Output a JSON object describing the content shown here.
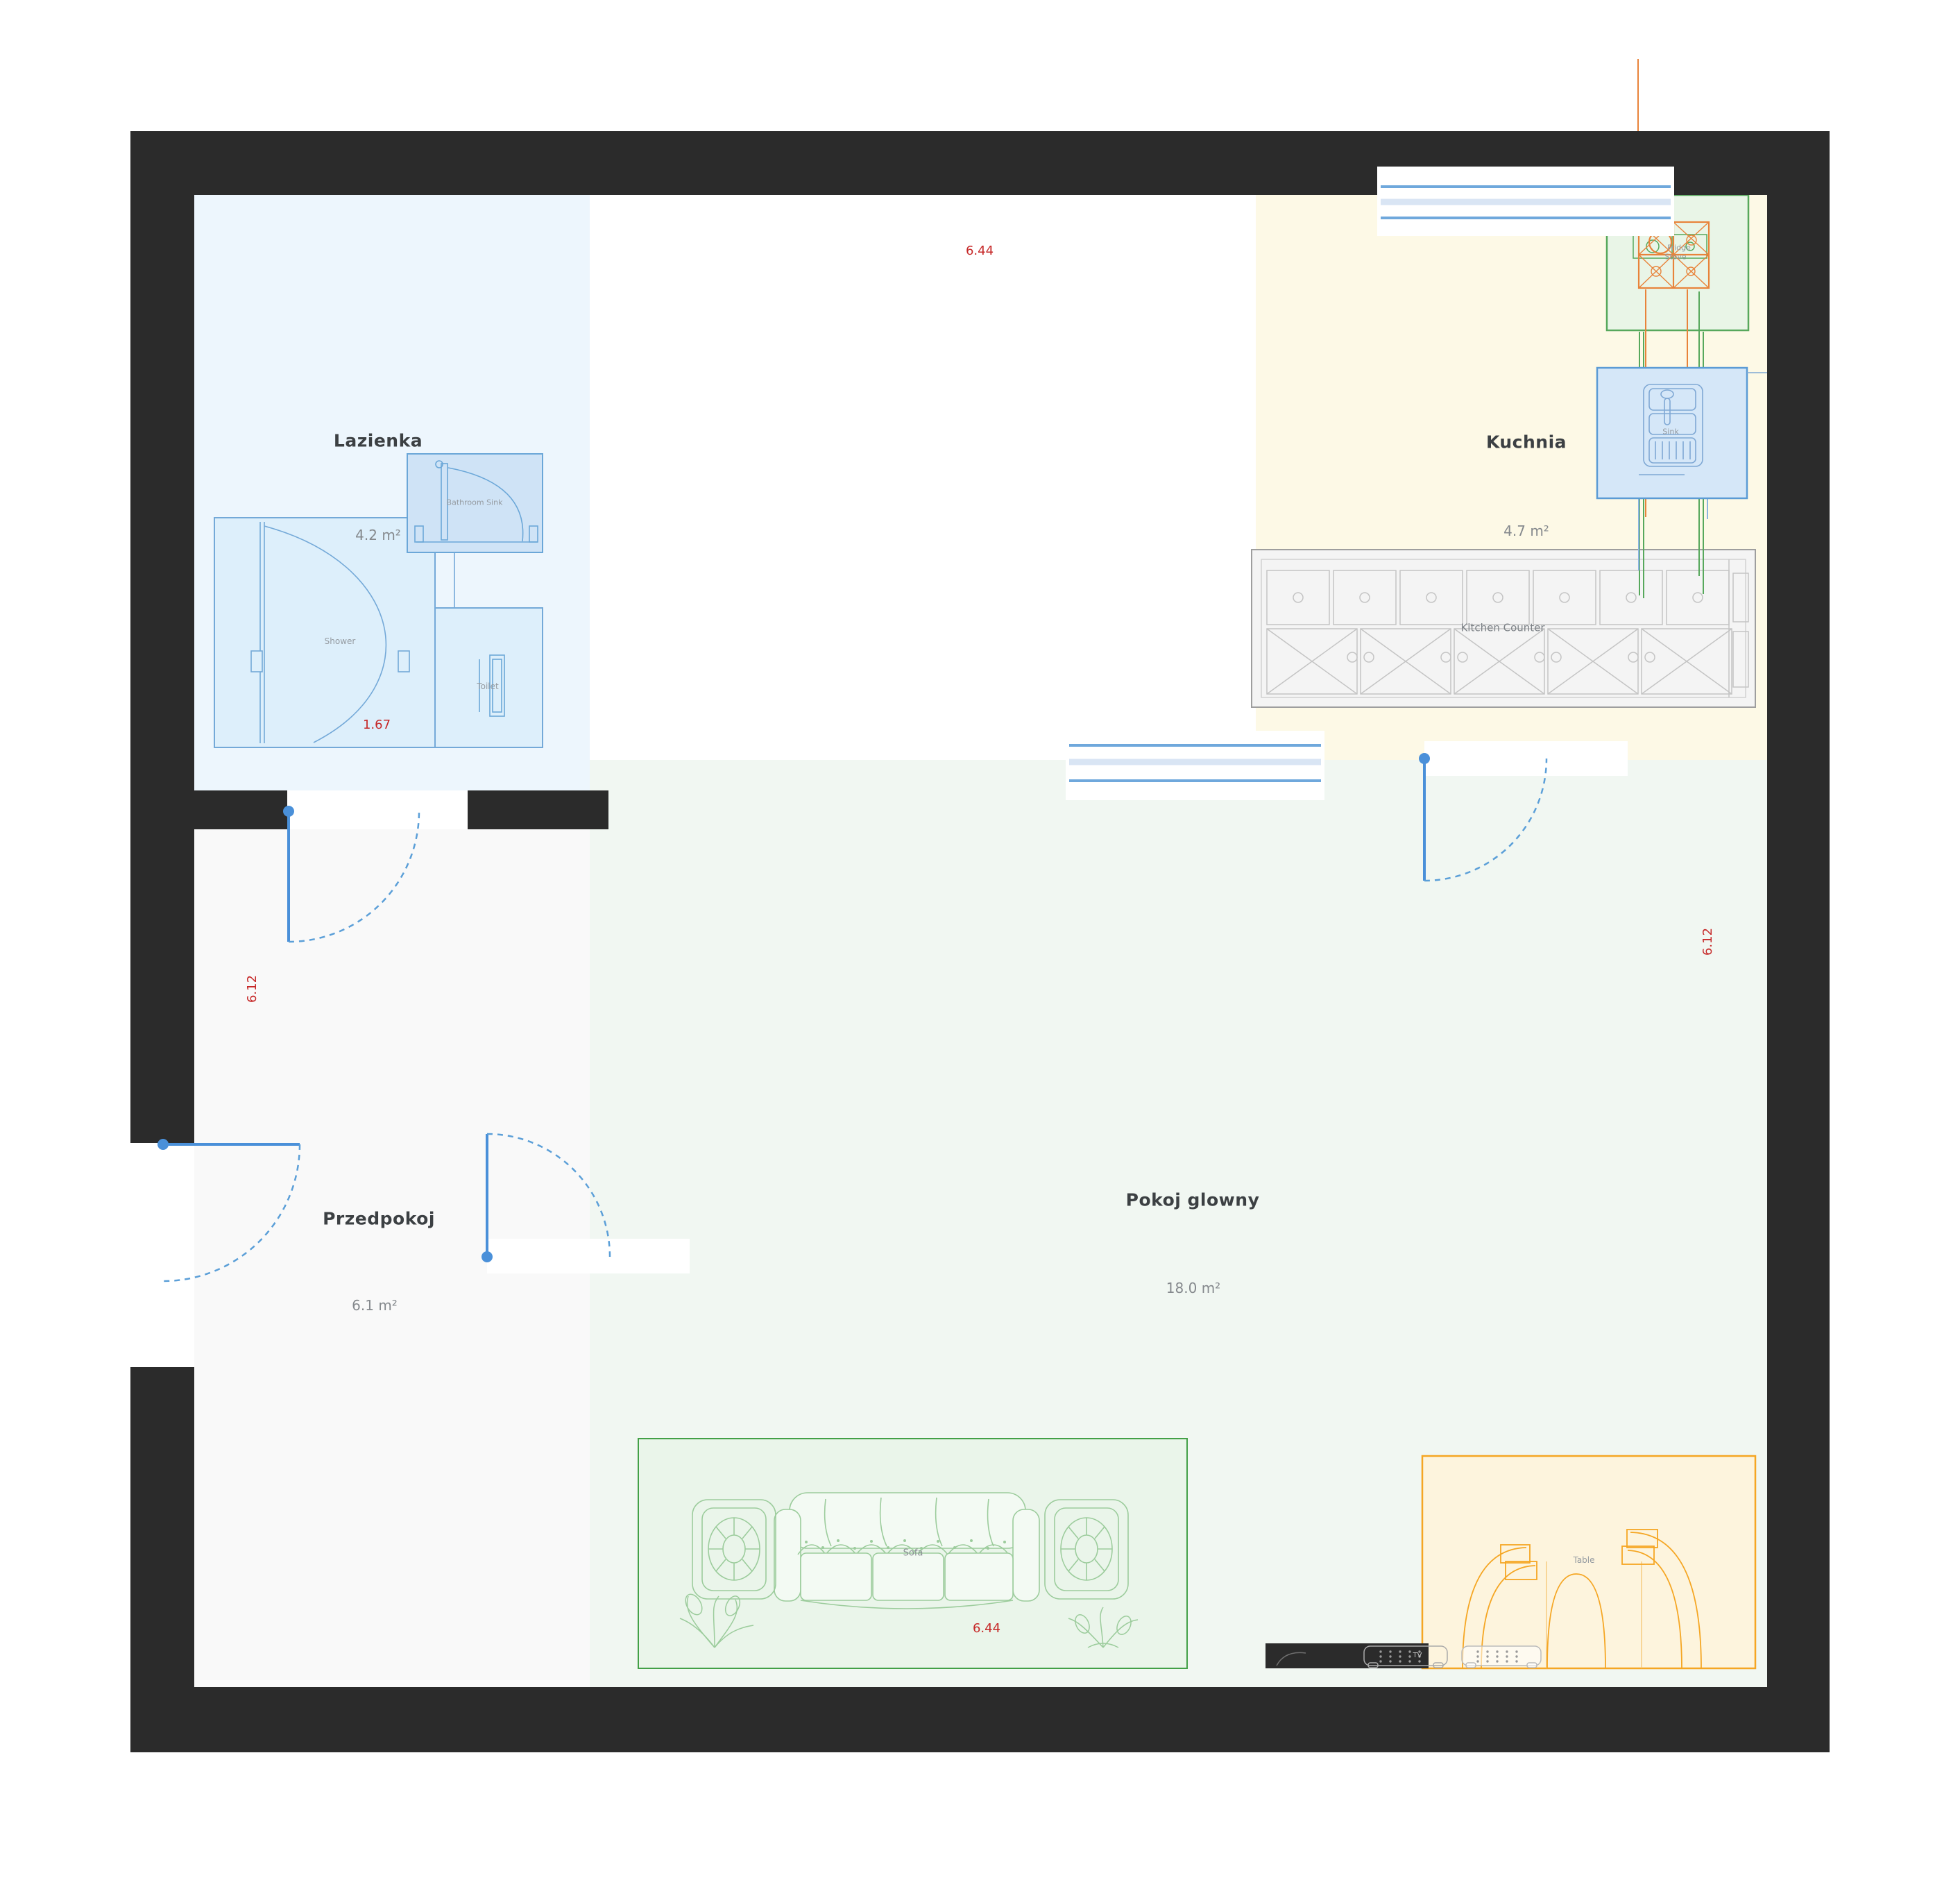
{
  "rooms": {
    "lazienka": {
      "name": "Lazienka",
      "area": "4.2 m²"
    },
    "kuchnia": {
      "name": "Kuchnia",
      "area": "4.7 m²"
    },
    "przedpokoj": {
      "name": "Przedpokoj",
      "area": "6.1 m²"
    },
    "pokoj_glowny": {
      "name": "Pokoj glowny",
      "area": "18.0 m²"
    }
  },
  "furniture": {
    "shower": "Shower",
    "toilet": "Toilet",
    "bathroom_sink": "Bathroom Sink",
    "sink": "Sink",
    "fridge": "Fridge",
    "stove": "Stove",
    "kitchen_counter": "Kitchen Counter",
    "sofa": "Sofa",
    "table": "Table",
    "tv": "TV"
  },
  "dimensions": {
    "top": "6.44",
    "bottom": "6.44",
    "left": "6.12",
    "right": "6.12",
    "shower_width": "1.67"
  },
  "colors": {
    "wall": "#2b2b2b",
    "bathroom_floor": "#edf6fd",
    "kitchen_floor": "#fdf9e6",
    "hall_floor": "#f9f9f9",
    "living_floor": "#f1f7f2",
    "door": "#4a90d9",
    "window": "#6fa8dc",
    "dimension_text": "#c62828",
    "sofa_zone": "#43a047",
    "table_zone": "#f5a623",
    "bath_fixture": "#74a9d8",
    "fridge": "#57a85c",
    "stove": "#e8833a"
  }
}
